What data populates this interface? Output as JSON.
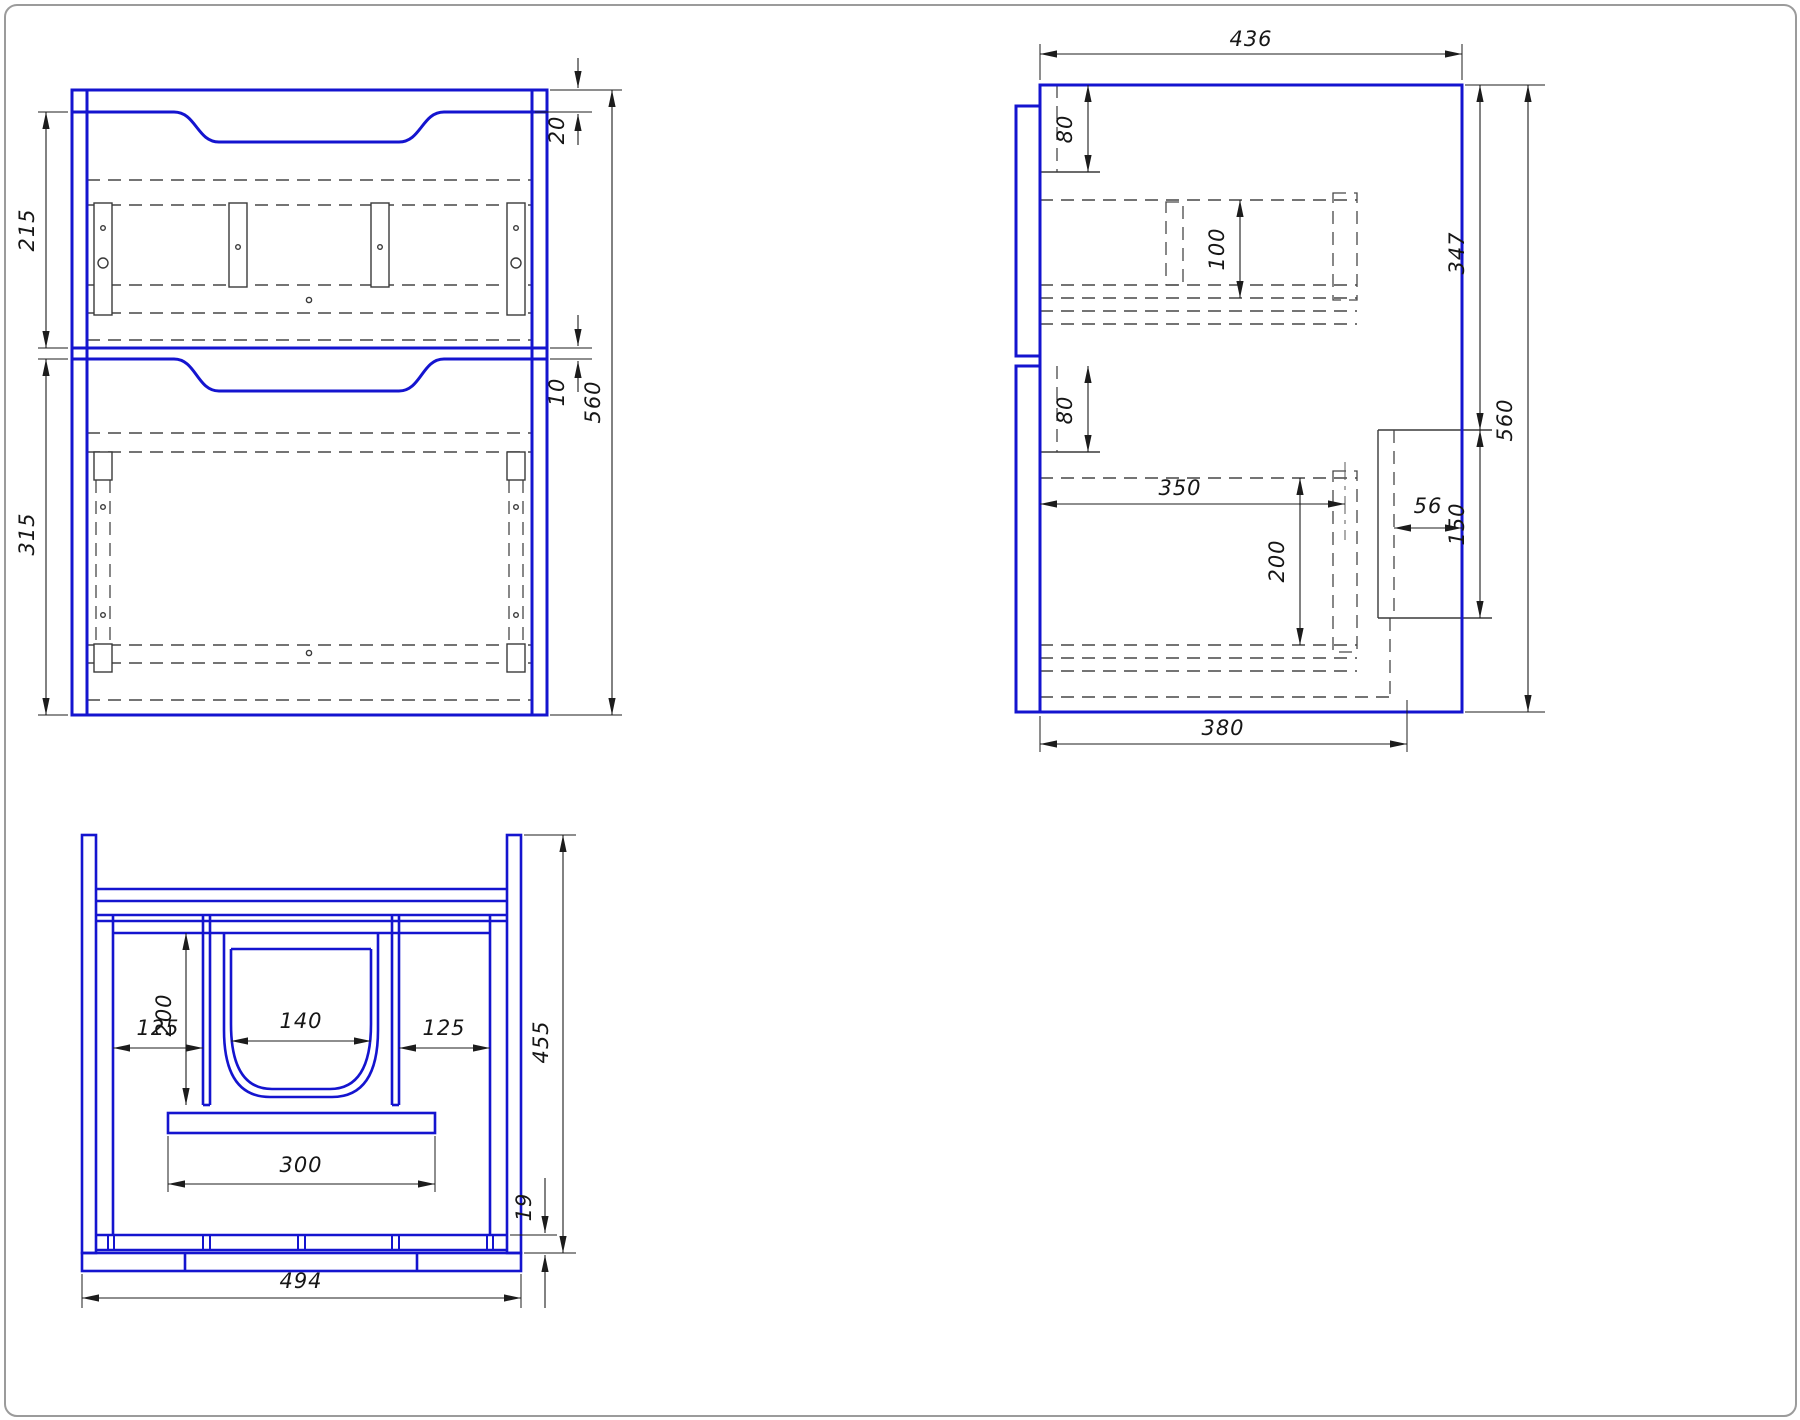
{
  "drawing": {
    "kind": "vanity-cabinet-technical-drawing",
    "colors": {
      "structure_blue": "#1414cf",
      "hidden_line": "#474747",
      "dimension": "#1c1c1c",
      "frame": "#9b9b9b"
    },
    "front_view": {
      "dims": {
        "top_rail_height": "20",
        "top_drawer_height": "215",
        "drawer_gap": "10",
        "bottom_drawer_height": "315",
        "total_height": "560"
      }
    },
    "side_view": {
      "dims": {
        "top_depth": "436",
        "back_rail_offset_top": "80",
        "slide_rail_height": "100",
        "upper_section_height": "347",
        "total_height": "560",
        "back_rail_offset_mid": "80",
        "rail_length": "350",
        "lower_rail_height": "200",
        "notch_width": "56",
        "notch_height": "150",
        "bottom_depth": "380"
      }
    },
    "top_view": {
      "dims": {
        "sink_cutout_width": "140",
        "partition_depth": "200",
        "left_offset": "125",
        "right_offset": "125",
        "drain_panel_width": "300",
        "total_depth": "455",
        "bottom_panel_thickness": "19",
        "total_width": "494"
      }
    }
  }
}
